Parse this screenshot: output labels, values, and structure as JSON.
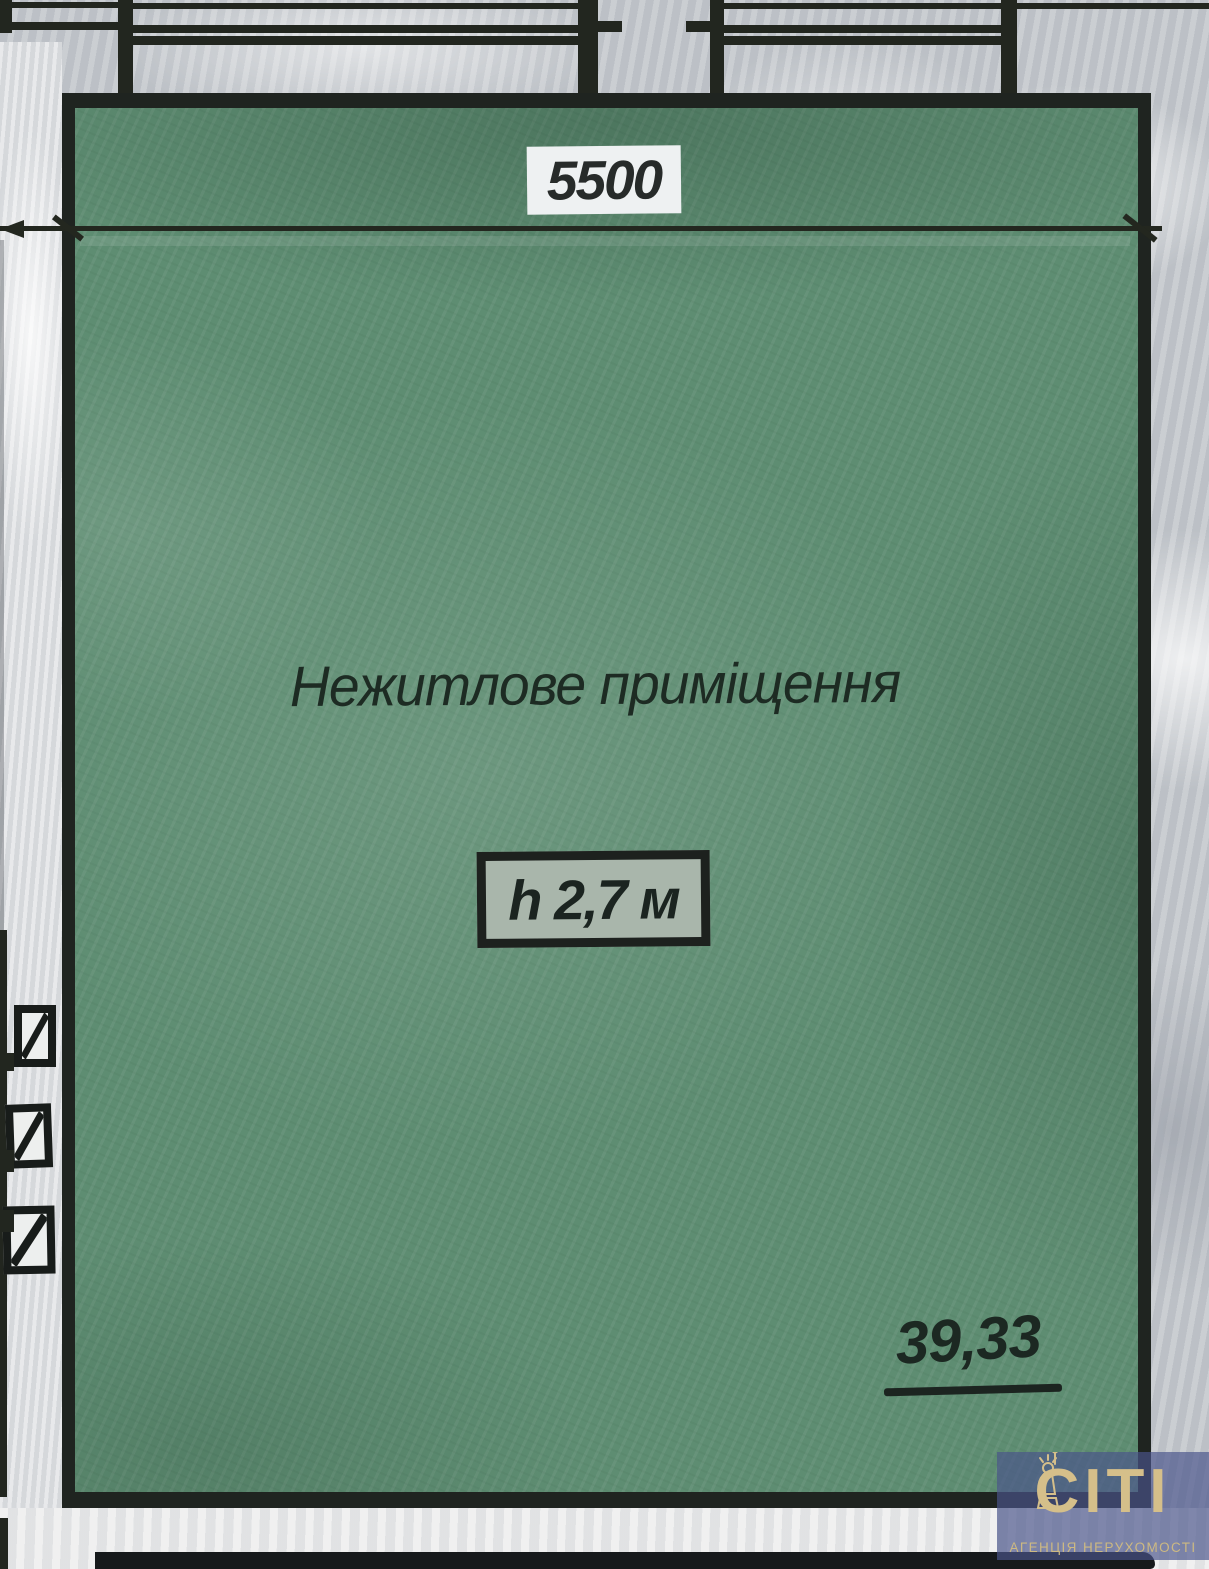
{
  "plan": {
    "dimension_label": "5500",
    "room_name": "Нежитлове приміщення",
    "height_label": "h 2,7 м",
    "area_label": "39,33"
  },
  "watermark": {
    "logo_text": "СІТІ",
    "caption": "АГЕНЦІЯ НЕРУХОМОСТІ"
  },
  "colors": {
    "room_fill": "#5e8d72",
    "wall_line": "#1f2420",
    "paper_marble": "#c2c6cb",
    "paper_white": "#e9eaea",
    "dimension_label_bg": "#eef1f2",
    "height_box_bg": "#a9b6ab",
    "watermark_bg": "#4a548a",
    "watermark_gold": "#d5bf8a"
  }
}
